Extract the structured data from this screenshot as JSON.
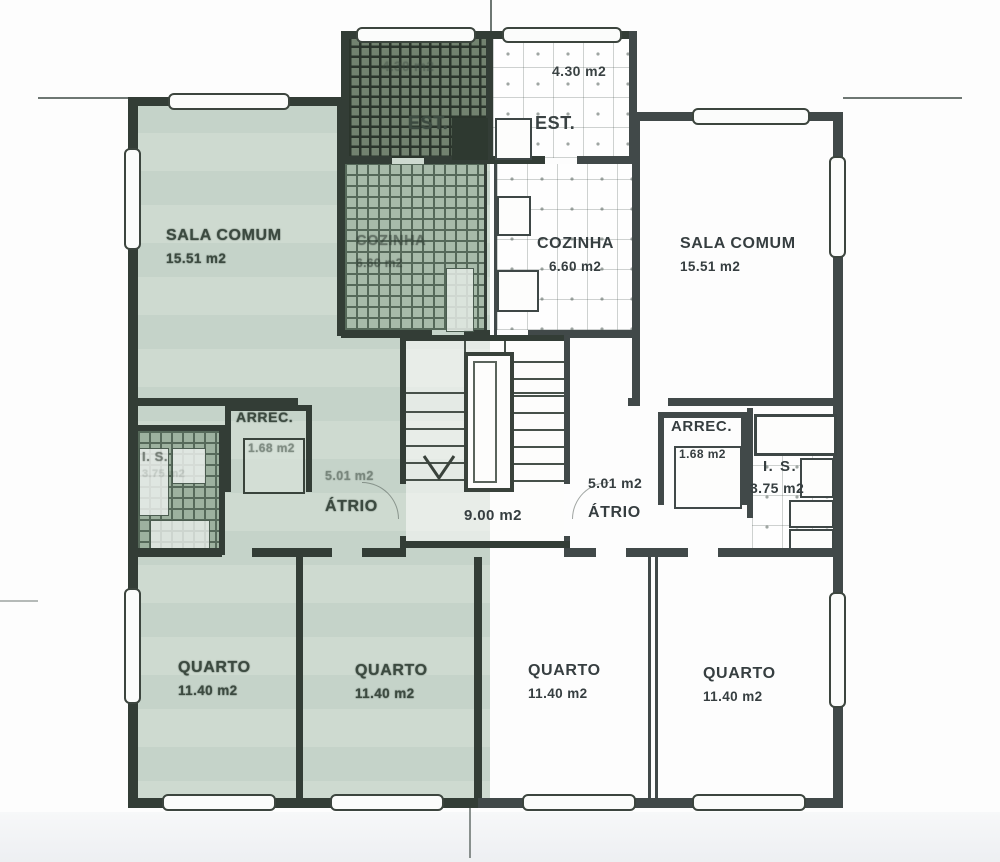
{
  "document": {
    "kind": "scanned apartment floor plan"
  },
  "colors": {
    "highlight_tint": "#cbd7cf",
    "wall_line_left": "#333d36",
    "wall_line_right": "#414949",
    "paper": "#fdfdfd"
  },
  "stairwell": {
    "area": "9.00 m2"
  },
  "left_apartment": {
    "est": {
      "name": "EST.",
      "area": "4.30 m2"
    },
    "sala_comum": {
      "name": "SALA COMUM",
      "area": "15.51 m2"
    },
    "cozinha": {
      "name": "COZINHA",
      "area": "6.60 m2"
    },
    "arrec": {
      "name": "ARREC.",
      "area": "1.68 m2"
    },
    "is": {
      "name": "I. S.",
      "area": "3.75 m2"
    },
    "atrio": {
      "name": "ÁTRIO",
      "area": "5.01 m2"
    },
    "quarto_1": {
      "name": "QUARTO",
      "area": "11.40 m2"
    },
    "quarto_2": {
      "name": "QUARTO",
      "area": "11.40 m2"
    }
  },
  "right_apartment": {
    "est": {
      "name": "EST.",
      "area": "4.30 m2"
    },
    "sala_comum": {
      "name": "SALA COMUM",
      "area": "15.51 m2"
    },
    "cozinha": {
      "name": "COZINHA",
      "area": "6.60 m2"
    },
    "arrec": {
      "name": "ARREC.",
      "area": "1.68 m2"
    },
    "is": {
      "name": "I. S.",
      "area": "3.75 m2"
    },
    "atrio": {
      "name": "ÁTRIO",
      "area": "5.01 m2"
    },
    "quarto_1": {
      "name": "QUARTO",
      "area": "11.40 m2"
    },
    "quarto_2": {
      "name": "QUARTO",
      "area": "11.40 m2"
    }
  }
}
